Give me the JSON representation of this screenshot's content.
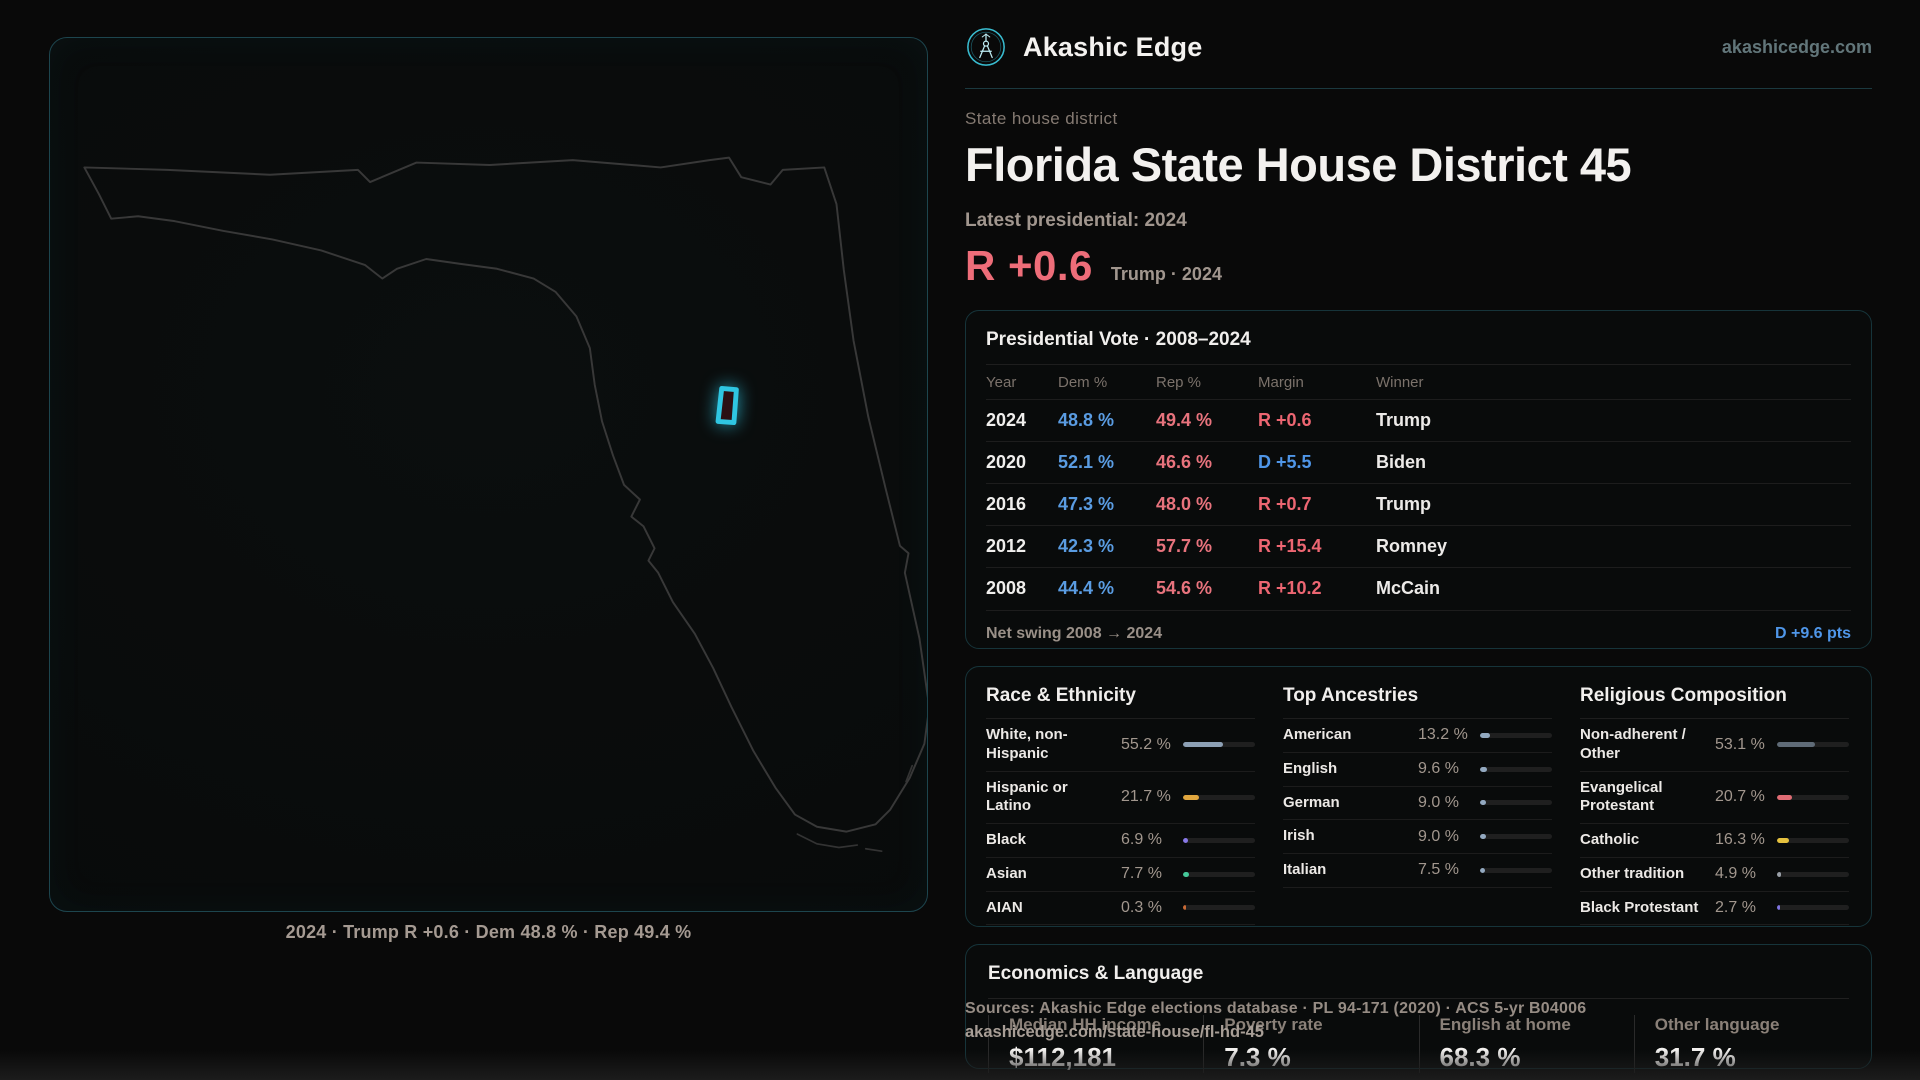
{
  "palette": {
    "dem": "#5a9ce2",
    "rep": "#e8737d",
    "margin_d": "#4f96e8",
    "margin_r": "#ed6672",
    "accent_red": "#ee6d79",
    "cyan": "#2fc6e2"
  },
  "brand": {
    "name": "Akashic Edge",
    "domain": "akashicedge.com"
  },
  "header": {
    "kicker": "State house district",
    "title": "Florida State House District 45",
    "context_label": "Latest presidential: 2024",
    "headline_margin": "R +0.6",
    "headline_detail": "Trump · 2024"
  },
  "map": {
    "caption": "2024 · Trump R +0.6 · Dem 48.8 % · Rep 49.4 %"
  },
  "vote_table": {
    "title": "Presidential Vote · 2008–2024",
    "columns": [
      "Year",
      "Dem %",
      "Rep %",
      "Margin",
      "Winner"
    ],
    "rows": [
      {
        "year": "2024",
        "dem": "48.8 %",
        "rep": "49.4 %",
        "margin": "R +0.6",
        "margin_party": "R",
        "winner": "Trump"
      },
      {
        "year": "2020",
        "dem": "52.1 %",
        "rep": "46.6 %",
        "margin": "D +5.5",
        "margin_party": "D",
        "winner": "Biden"
      },
      {
        "year": "2016",
        "dem": "47.3 %",
        "rep": "48.0 %",
        "margin": "R +0.7",
        "margin_party": "R",
        "winner": "Trump"
      },
      {
        "year": "2012",
        "dem": "42.3 %",
        "rep": "57.7 %",
        "margin": "R +15.4",
        "margin_party": "R",
        "winner": "Romney"
      },
      {
        "year": "2008",
        "dem": "44.4 %",
        "rep": "54.6 %",
        "margin": "R +10.2",
        "margin_party": "R",
        "winner": "McCain"
      }
    ],
    "net_swing_label": "Net swing 2008 → 2024",
    "net_swing_value": "D +9.6 pts"
  },
  "demographics": [
    {
      "title": "Race & Ethnicity",
      "rows": [
        {
          "label": "White, non-Hispanic",
          "value": "55.2 %",
          "pct": 55.2,
          "color": "#8da0b5"
        },
        {
          "label": "Hispanic or Latino",
          "value": "21.7 %",
          "pct": 21.7,
          "color": "#e0a63e"
        },
        {
          "label": "Black",
          "value": "6.9 %",
          "pct": 6.9,
          "color": "#8878e8"
        },
        {
          "label": "Asian",
          "value": "7.7 %",
          "pct": 7.7,
          "color": "#45c99a"
        },
        {
          "label": "AIAN",
          "value": "0.3 %",
          "pct": 0.3,
          "color": "#c96a35"
        }
      ]
    },
    {
      "title": "Top Ancestries",
      "rows": [
        {
          "label": "American",
          "value": "13.2 %",
          "pct": 13.2,
          "color": "#93a9c0"
        },
        {
          "label": "English",
          "value": "9.6 %",
          "pct": 9.6,
          "color": "#93a9c0"
        },
        {
          "label": "German",
          "value": "9.0 %",
          "pct": 9.0,
          "color": "#93a9c0"
        },
        {
          "label": "Irish",
          "value": "9.0 %",
          "pct": 9.0,
          "color": "#93a9c0"
        },
        {
          "label": "Italian",
          "value": "7.5 %",
          "pct": 7.5,
          "color": "#93a9c0"
        }
      ]
    },
    {
      "title": "Religious Composition",
      "rows": [
        {
          "label": "Non-adherent / Other",
          "value": "53.1 %",
          "pct": 53.1,
          "color": "#5f6b77"
        },
        {
          "label": "Evangelical Protestant",
          "value": "20.7 %",
          "pct": 20.7,
          "color": "#e06c74"
        },
        {
          "label": "Catholic",
          "value": "16.3 %",
          "pct": 16.3,
          "color": "#e6c23f"
        },
        {
          "label": "Other tradition",
          "value": "4.9 %",
          "pct": 4.9,
          "color": "#9aa0a8"
        },
        {
          "label": "Black Protestant",
          "value": "2.7 %",
          "pct": 2.7,
          "color": "#7f74e0"
        }
      ]
    }
  ],
  "economics": {
    "title": "Economics & Language",
    "stats": [
      {
        "label": "Median HH income",
        "value": "$112,181"
      },
      {
        "label": "Poverty rate",
        "value": "7.3 %"
      },
      {
        "label": "English at home",
        "value": "68.3 %"
      },
      {
        "label": "Other language",
        "value": "31.7 %"
      }
    ]
  },
  "footer": {
    "sources": "Sources: Akashic Edge elections database · PL 94-171 (2020) · ACS 5-yr B04006",
    "permalink": "akashicedge.com/state-house/fl-hd-45"
  }
}
